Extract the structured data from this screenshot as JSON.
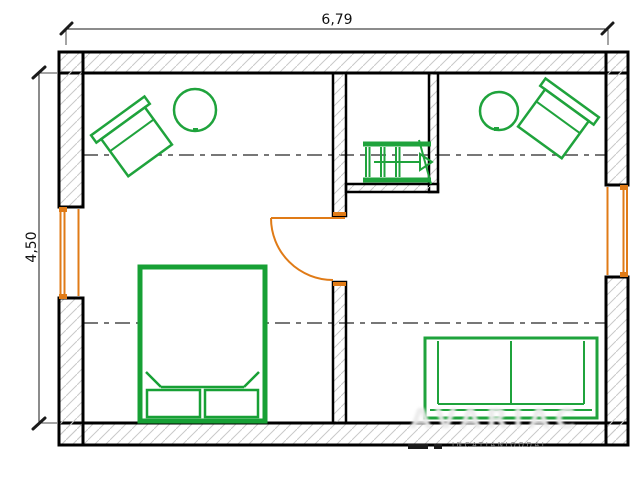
{
  "page": {
    "type": "architectural-floor-plan",
    "background": "#ffffff"
  },
  "dimensions": {
    "width": {
      "label": "6,79"
    },
    "height": {
      "label": "4,50"
    }
  },
  "colors": {
    "wall": "#000000",
    "hatch": "#c9c9c9",
    "furniture": "#1fa33c",
    "bed": "#17a035",
    "opening": "#e07b17",
    "dashline": "#4a4a4a",
    "dimension": "#1a1a1a",
    "watermark_large": "#ebebeb",
    "watermark_small": "#8a8a8a"
  },
  "symbols": [
    "exterior-hatched-wall",
    "interior-hatched-wall",
    "window",
    "door-swing",
    "staircase-with-up-arrow",
    "armchair",
    "round-side-table",
    "double-bed-with-pillows",
    "two-seat-sofa",
    "roof-height-dash-dot-line"
  ],
  "watermark": {
    "large": "AVARIAC",
    "small": "INCATIANIOODAI"
  }
}
